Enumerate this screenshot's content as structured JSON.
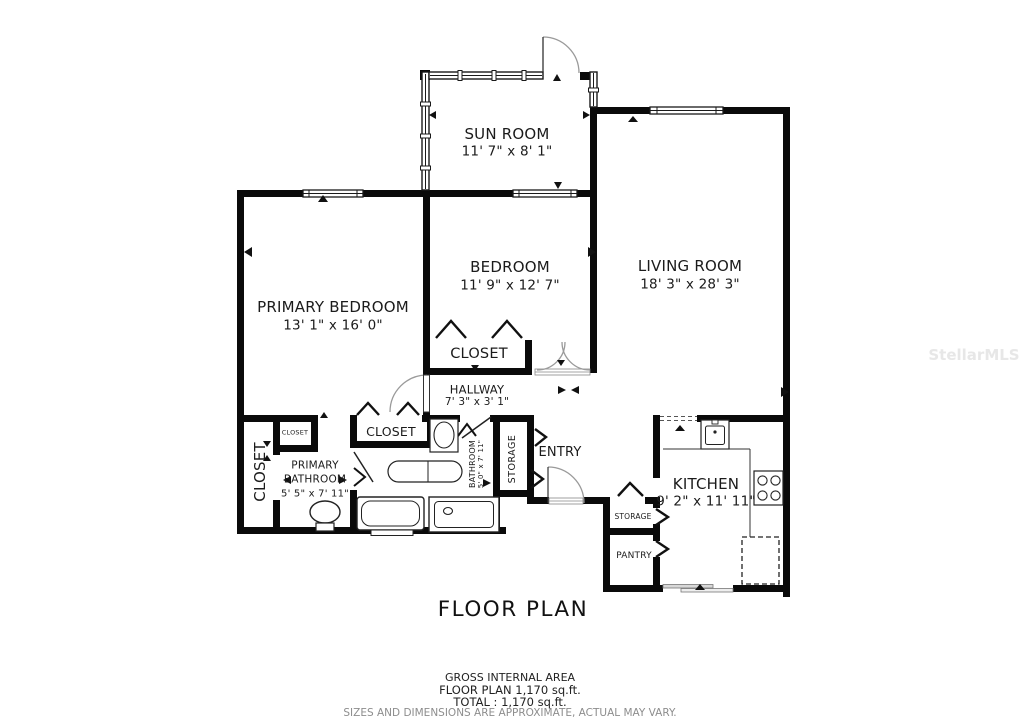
{
  "title": "FLOOR PLAN",
  "watermark": "StellarMLS",
  "rooms": {
    "sun_room": {
      "name": "SUN ROOM",
      "dims": "11' 7\" x 8' 1\""
    },
    "primary_bedroom": {
      "name": "PRIMARY BEDROOM",
      "dims": "13' 1\" x 16' 0\""
    },
    "bedroom": {
      "name": "BEDROOM",
      "dims": "11' 9\" x 12' 7\""
    },
    "living_room": {
      "name": "LIVING ROOM",
      "dims": "18' 3\" x 28' 3\""
    },
    "bedroom_closet": {
      "name": "CLOSET"
    },
    "hallway": {
      "name": "HALLWAY",
      "dims": "7' 3\" x 3' 1\""
    },
    "left_closet": {
      "name": "CLOSET"
    },
    "small_closet": {
      "name": "CLOSET"
    },
    "primary_bathroom": {
      "name": "PRIMARY BATHROOM",
      "dims": "5' 5\" x 7' 11\""
    },
    "middle_closet": {
      "name": "CLOSET"
    },
    "bathroom": {
      "name": "BATHROOM",
      "dims": "5' 0\" x 7' 11\""
    },
    "hall_storage": {
      "name": "STORAGE"
    },
    "entry": {
      "name": "ENTRY"
    },
    "kitchen": {
      "name": "KITCHEN",
      "dims": "9' 2\" x 11' 11\""
    },
    "kitchen_storage": {
      "name": "STORAGE"
    },
    "pantry": {
      "name": "PANTRY"
    }
  },
  "footer": {
    "gross_label": "GROSS INTERNAL AREA",
    "floor_plan_area": "FLOOR PLAN 1,170 sq.ft.",
    "total_area": "TOTAL :  1,170 sq.ft.",
    "disclaimer": "SIZES AND DIMENSIONS ARE APPROXIMATE, ACTUAL MAY VARY."
  }
}
